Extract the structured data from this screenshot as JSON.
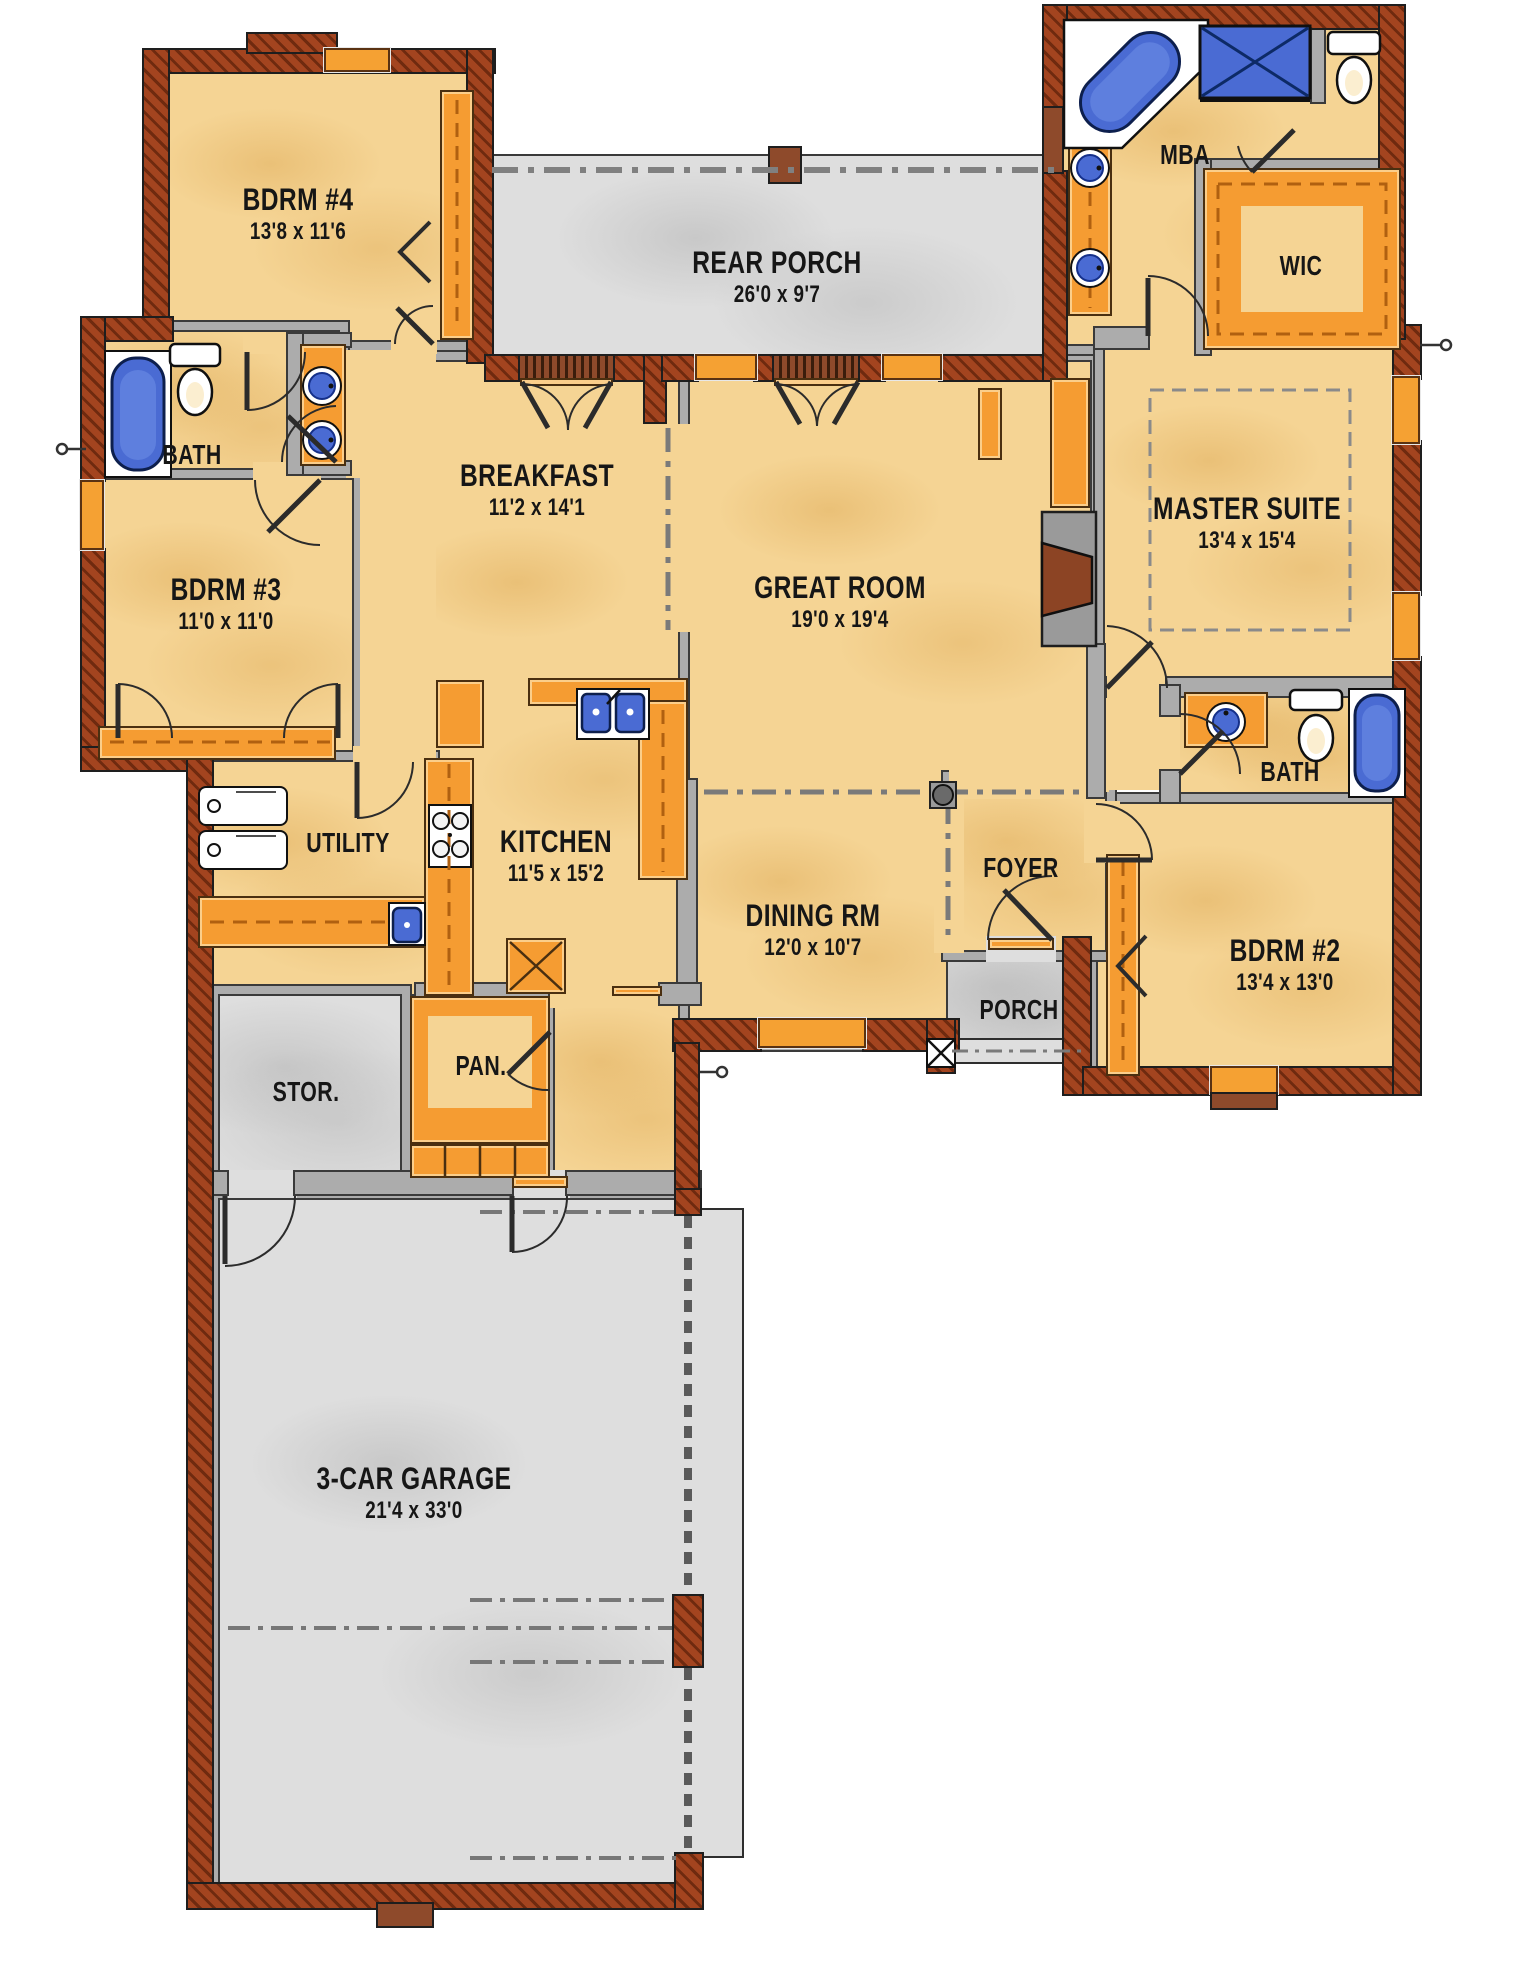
{
  "plan": {
    "type": "floor-plan",
    "rooms": [
      {
        "name": "BDRM #4",
        "dims": "13'8 x 11'6"
      },
      {
        "name": "BATH",
        "dims": ""
      },
      {
        "name": "BDRM #3",
        "dims": "11'0 x 11'0"
      },
      {
        "name": "REAR PORCH",
        "dims": "26'0 x 9'7"
      },
      {
        "name": "MBA",
        "dims": ""
      },
      {
        "name": "WIC",
        "dims": ""
      },
      {
        "name": "BREAKFAST",
        "dims": "11'2 x 14'1"
      },
      {
        "name": "GREAT ROOM",
        "dims": "19'0 x 19'4"
      },
      {
        "name": "MASTER SUITE",
        "dims": "13'4 x 15'4"
      },
      {
        "name": "UTILITY",
        "dims": ""
      },
      {
        "name": "KITCHEN",
        "dims": "11'5 x 15'2"
      },
      {
        "name": "DINING RM",
        "dims": "12'0 x 10'7"
      },
      {
        "name": "FOYER",
        "dims": ""
      },
      {
        "name": "BATH",
        "dims": ""
      },
      {
        "name": "BDRM #2",
        "dims": "13'4 x 13'0"
      },
      {
        "name": "STOR.",
        "dims": ""
      },
      {
        "name": "PAN.",
        "dims": ""
      },
      {
        "name": "PORCH",
        "dims": ""
      },
      {
        "name": "3-CAR GARAGE",
        "dims": "21'4 x 33'0"
      }
    ],
    "colors": {
      "floor_tan": "#F5D494",
      "floor_gray": "#DEDEDE",
      "cabinet_orange": "#F59C32",
      "fixture_blue": "#4A6BD3",
      "brick_red": "#A3441F",
      "wall_gray": "#ACACAC",
      "line_dark": "#2B2B2B",
      "text": "#161616"
    },
    "fixtures": [
      "corner-tub",
      "walk-in-shower",
      "toilet",
      "double-vanity-sinks",
      "tub",
      "kitchen-range",
      "kitchen-double-sink",
      "refrigerator-space",
      "washer-dryer",
      "utility-sink",
      "fireplace",
      "decorative-column",
      "closet-shelving",
      "porch-post",
      "hose-bib"
    ]
  }
}
